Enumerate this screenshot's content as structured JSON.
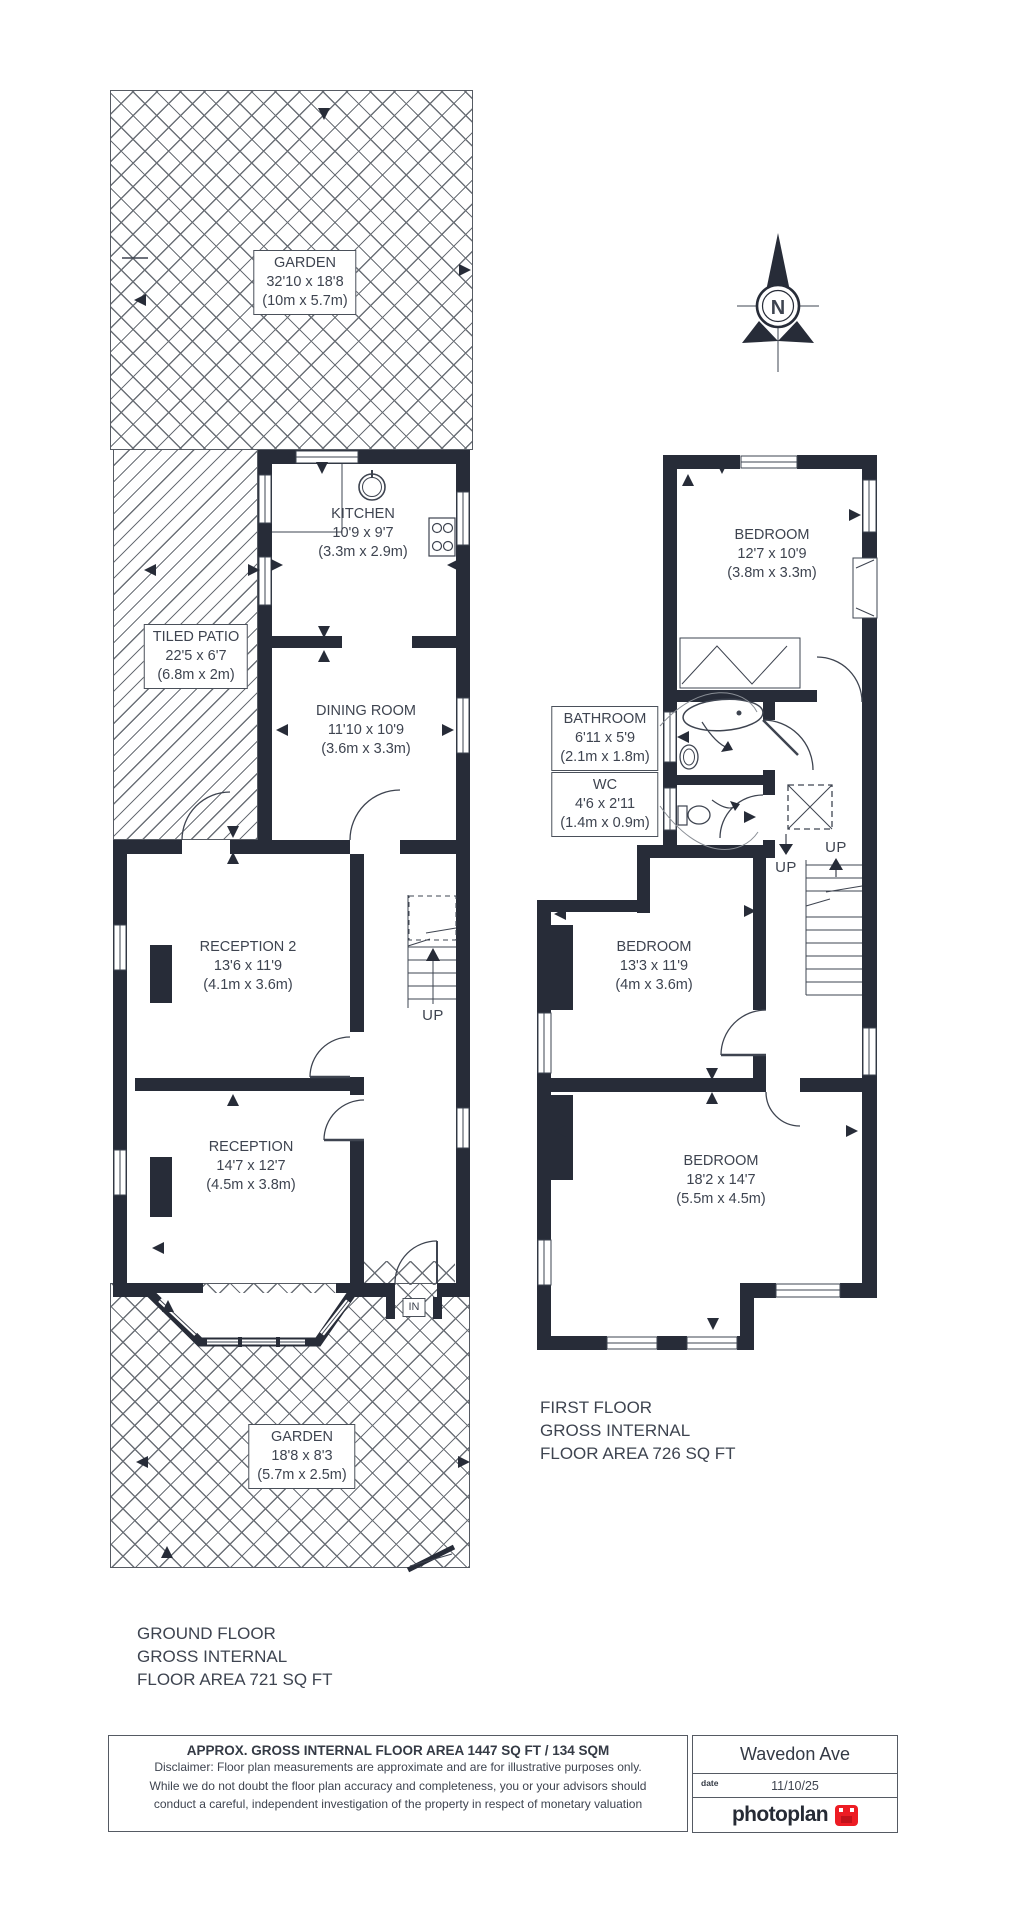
{
  "compass": {
    "label": "N"
  },
  "ground_floor": {
    "garden_top": {
      "name": "GARDEN",
      "imperial": "32'10 x 18'8",
      "metric": "(10m x 5.7m)"
    },
    "patio": {
      "name": "TILED PATIO",
      "imperial": "22'5 x 6'7",
      "metric": "(6.8m x 2m)"
    },
    "kitchen": {
      "name": "KITCHEN",
      "imperial": "10'9 x 9'7",
      "metric": "(3.3m x 2.9m)"
    },
    "dining": {
      "name": "DINING ROOM",
      "imperial": "11'10 x 10'9",
      "metric": "(3.6m x 3.3m)"
    },
    "reception2": {
      "name": "RECEPTION 2",
      "imperial": "13'6 x 11'9",
      "metric": "(4.1m x 3.6m)"
    },
    "reception": {
      "name": "RECEPTION",
      "imperial": "14'7 x 12'7",
      "metric": "(4.5m x 3.8m)"
    },
    "garden_bottom": {
      "name": "GARDEN",
      "imperial": "18'8 x 8'3",
      "metric": "(5.7m x 2.5m)"
    },
    "up_label": "UP",
    "in_label": "IN",
    "caption": {
      "line1": "GROUND FLOOR",
      "line2": "GROSS INTERNAL",
      "line3": "FLOOR AREA 721 SQ FT"
    }
  },
  "first_floor": {
    "bedroom1": {
      "name": "BEDROOM",
      "imperial": "12'7 x 10'9",
      "metric": "(3.8m x 3.3m)"
    },
    "bathroom": {
      "name": "BATHROOM",
      "imperial": "6'11 x 5'9",
      "metric": "(2.1m x 1.8m)"
    },
    "wc": {
      "name": "WC",
      "imperial": "4'6 x 2'11",
      "metric": "(1.4m x 0.9m)"
    },
    "bedroom2": {
      "name": "BEDROOM",
      "imperial": "13'3 x 11'9",
      "metric": "(4m x 3.6m)"
    },
    "bedroom3": {
      "name": "BEDROOM",
      "imperial": "18'2 x 14'7",
      "metric": "(5.5m x 4.5m)"
    },
    "up_label_1": "UP",
    "up_label_2": "UP",
    "caption": {
      "line1": "FIRST FLOOR",
      "line2": "GROSS INTERNAL",
      "line3": "FLOOR AREA 726 SQ FT"
    }
  },
  "footer": {
    "title": "APPROX. GROSS INTERNAL FLOOR AREA 1447 SQ FT / 134 SQM",
    "disclaimer_line1": "Disclaimer: Floor plan measurements are approximate and are for illustrative purposes only.",
    "disclaimer_line2": "While we do not doubt the floor plan accuracy and completeness, you or your advisors should",
    "disclaimer_line3": "conduct a careful, independent investigation of the property in respect of monetary valuation",
    "address": "Wavedon Ave",
    "date_label": "date",
    "date_value": "11/10/25",
    "brand": "photoplan"
  },
  "colors": {
    "wall": "#272c38",
    "line": "#3e4450",
    "accent_red": "#ed1c24"
  }
}
